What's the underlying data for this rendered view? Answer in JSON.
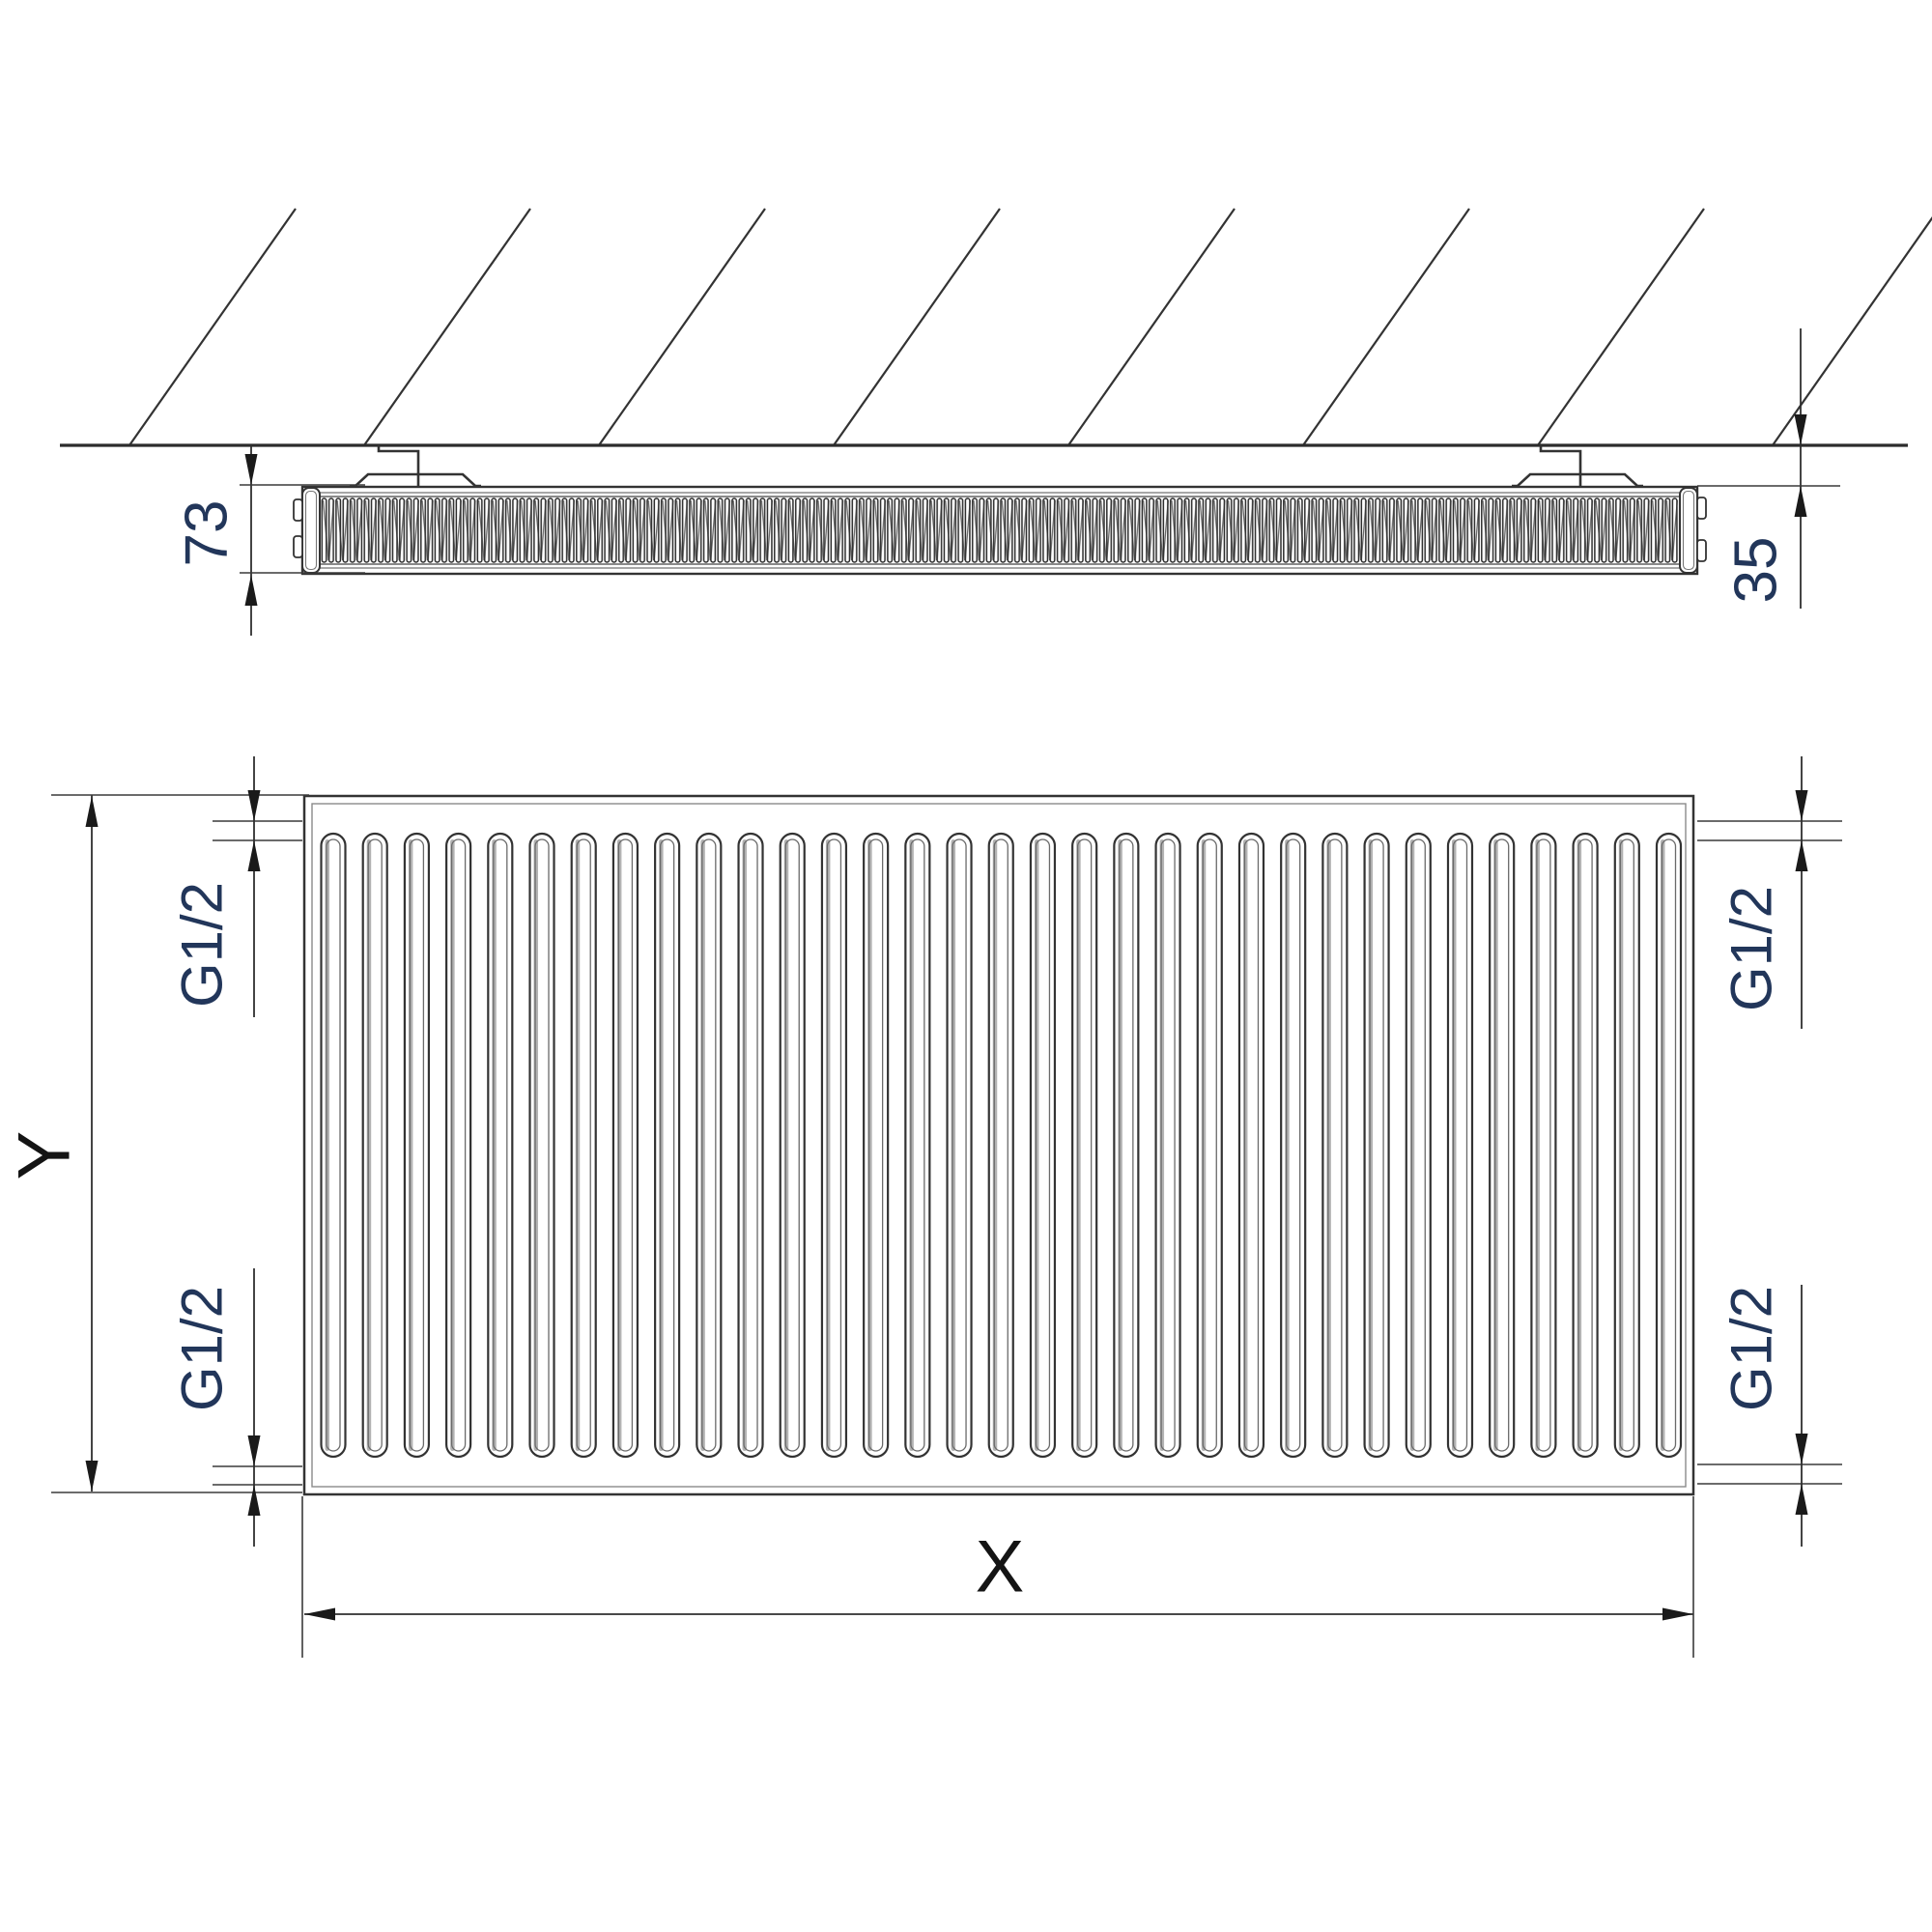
{
  "drawing": {
    "type": "technical-drawing",
    "subject": "panel radiator dimensional diagram, top profile view and front view",
    "views": {
      "wall": {
        "hatch_count": 8
      },
      "top_view": {
        "labels": {
          "depth": "73",
          "wall_clearance": "35"
        },
        "bracket_count": 2
      },
      "front_view": {
        "labels": {
          "width": "X",
          "height": "Y",
          "connection_top_left": "G1/2",
          "connection_bottom_left": "G1/2",
          "connection_top_right": "G1/2",
          "connection_bottom_right": "G1/2"
        },
        "fin_count": 33
      }
    },
    "colors": {
      "line": "#333333",
      "dimension_text": "#22365a",
      "axis_label_text": "#141414",
      "background": "#ffffff"
    }
  }
}
